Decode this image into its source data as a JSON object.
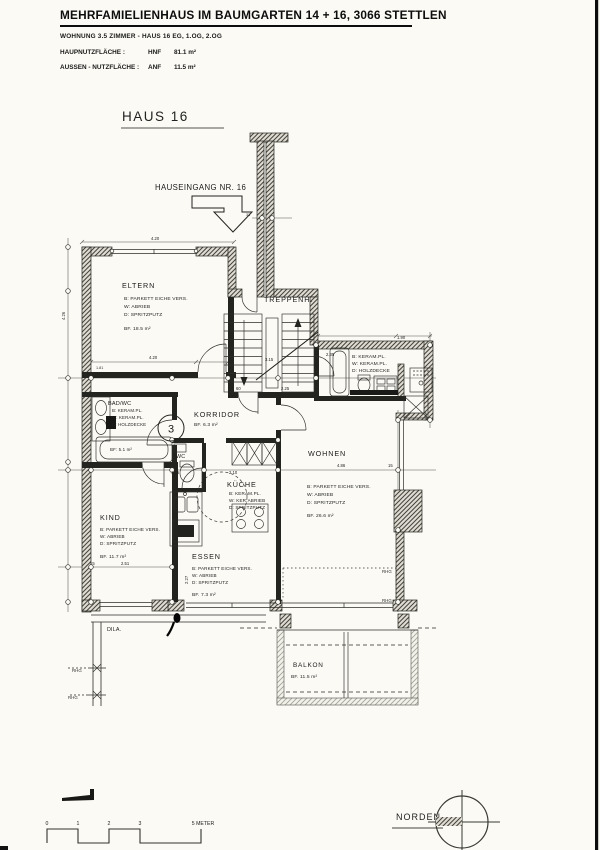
{
  "header": {
    "title": "MEHRFAMIELIENHAUS IM BAUMGARTEN 14 + 16, 3066 STETTLEN",
    "subtitle": "WOHNUNG 3.5 ZIMMER - HAUS  16 EG, 1.OG, 2.OG",
    "rows": [
      {
        "label": "HAUPNUTZFLÄCHE :",
        "code": "HNF",
        "value": "81.1 m²"
      },
      {
        "label": "AUSSEN - NUTZFLÄCHE :",
        "code": "ANF",
        "value": "11.5 m²"
      }
    ]
  },
  "plan": {
    "haus_label": "HAUS  16",
    "entrance_label": "HAUSEINGANG NR. 16",
    "apartment_number": "3",
    "rooms": {
      "eltern": {
        "name": "ELTERN",
        "floor": "B:  PARKETT EICHE VERS.",
        "wall": "W: ABRIEB",
        "ceiling": "D: SPRITZPUTZ",
        "area": "BF.  18.5 m²"
      },
      "treppenhaus": {
        "name": "TREPPENH."
      },
      "bad_og": {
        "floor": "B:  KERAM.PL.",
        "wall": "W: KERAM.PL.",
        "ceiling": "D: HOLZDECKE"
      },
      "bad_wc": {
        "name": "BAD/WC",
        "floor": "B: KERAM.PL.",
        "wall": "W: KERAM.PL.",
        "ceiling": "D: HOLZDECKE",
        "area": "BF: 5.1 m²"
      },
      "korridor": {
        "name": "KORRIDOR",
        "area": "BF.  6.3 m²"
      },
      "wohnen": {
        "name": "WOHNEN",
        "floor": "B:  PARKETT EICHE VERS.",
        "wall": "W: ABRIEB",
        "ceiling": "D: SPRITZPUTZ",
        "area": "BF.  26.6 m²"
      },
      "kueche": {
        "name": "KÜCHE",
        "floor": "B:  KERAM.PL.",
        "wall": "W: KER.ABRIEB",
        "ceiling": "D: SPRITZPUTZ"
      },
      "wc": {
        "name": "WC"
      },
      "kind": {
        "name": "KIND",
        "floor": "B:  PARKETT EICHE VERS.",
        "wall": "W: ABRIEB",
        "ceiling": "D: SPRITZPUTZ",
        "area": "BF.  11.7 m²"
      },
      "essen": {
        "name": "ESSEN",
        "floor": "B:  PARKETT EICHE VERS.",
        "wall": "W: ABRIEB",
        "ceiling": "D: SPRITZPUTZ",
        "area": "BF.  7.3 m²"
      },
      "balkon": {
        "name": "BALKON",
        "area": "BF.  11.5 m²"
      }
    },
    "annotations": {
      "dila": "DILA.",
      "rhg": "RHG"
    },
    "dims": [
      "4.20",
      "4.26",
      "4.20",
      "3.15",
      "2.25",
      "60",
      "2.35",
      "1.90",
      "4.86",
      "15",
      "2.51",
      "15",
      "1.35",
      "2.10",
      "2.27",
      "1.81",
      "33"
    ]
  },
  "footer": {
    "north_label": "NORDEN",
    "scale": {
      "ticks": [
        "0",
        "1",
        "2",
        "3"
      ],
      "end_label": "5 METER"
    }
  }
}
